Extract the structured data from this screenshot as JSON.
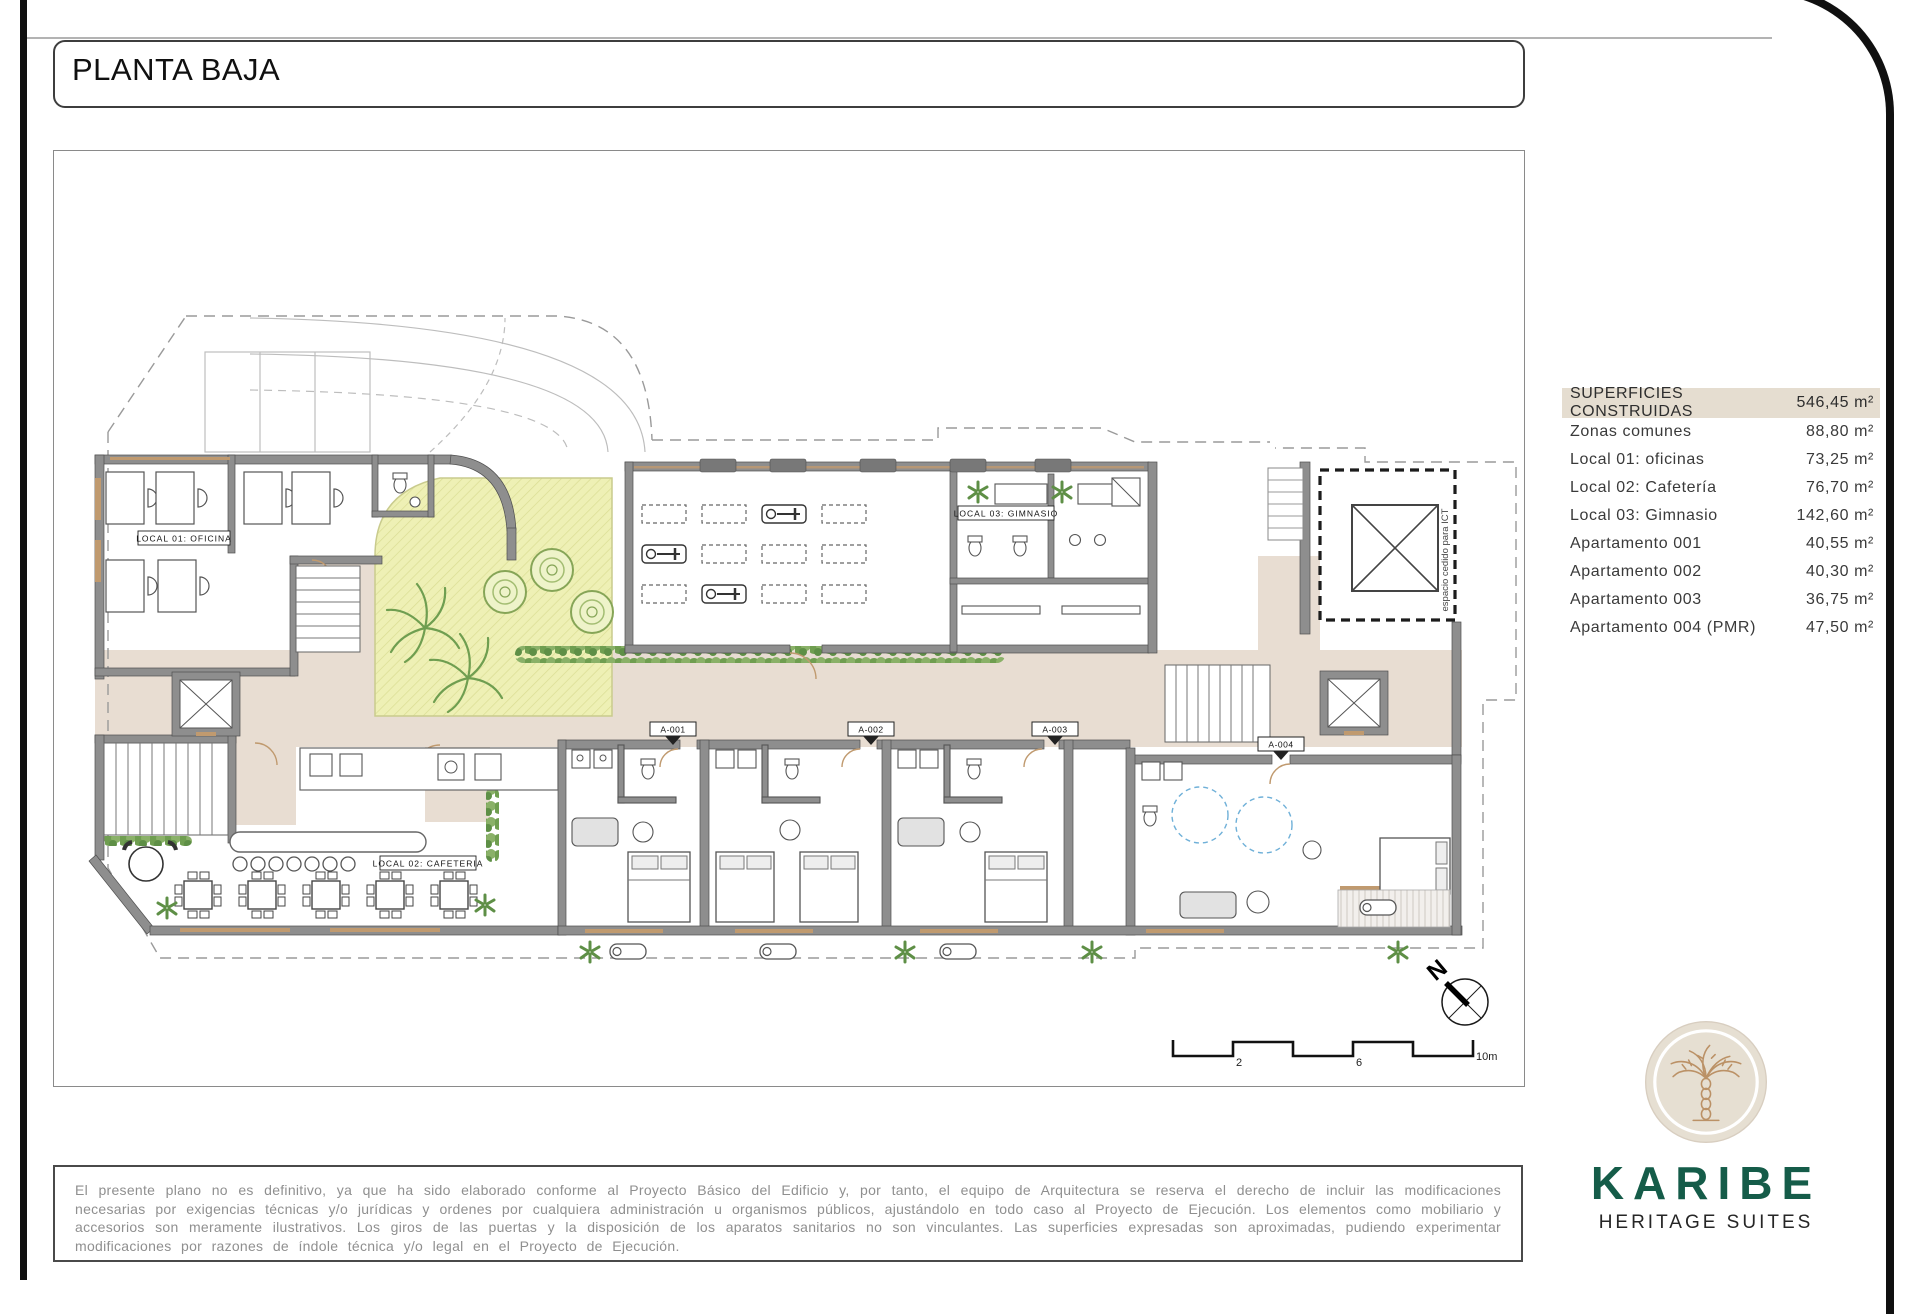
{
  "page": {
    "title": "PLANTA BAJA"
  },
  "plan": {
    "labels": {
      "local01": "LOCAL 01: OFICINA",
      "local02": "LOCAL 02: CAFETERIA",
      "local03": "LOCAL 03: GIMNASIO",
      "ict": "espacio cedido para ICT",
      "north": "N"
    },
    "apartment_tags": [
      "A-001",
      "A-002",
      "A-003",
      "A-004"
    ],
    "scale": {
      "t2": "2",
      "t6": "6",
      "t10": "10m"
    }
  },
  "areas_table": {
    "header": {
      "label": "SUPERFICIES CONSTRUIDAS",
      "value": "546,45 m²"
    },
    "rows": [
      {
        "label": "Zonas comunes",
        "value": "88,80 m²"
      },
      {
        "label": "Local 01:  oficinas",
        "value": "73,25 m²"
      },
      {
        "label": "Local 02:  Cafetería",
        "value": "76,70 m²"
      },
      {
        "label": "Local 03:  Gimnasio",
        "value": "142,60 m²"
      },
      {
        "label": "Apartamento 001",
        "value": "40,55 m²"
      },
      {
        "label": "Apartamento 002",
        "value": "40,30 m²"
      },
      {
        "label": "Apartamento 003",
        "value": "36,75 m²"
      },
      {
        "label": "Apartamento 004 (PMR)",
        "value": "47,50 m²"
      }
    ]
  },
  "disclaimer": {
    "text": "El presente plano no es definitivo, ya que ha sido elaborado conforme al Proyecto Básico del Edificio y, por tanto, el equipo de Arquitectura se reserva el derecho de incluir las modificaciones necesarias por exigencias técnicas y/o jurídicas y ordenes por cualquiera administración u organismos públicos, ajustándolo en todo caso al Proyecto de Ejecución. Los elementos como mobiliario y accesorios son meramente ilustrativos. Los giros de las puertas y la disposición de los aparatos sanitarios no son vinculantes. Las superficies expresadas son aproximadas, pudiendo experimentar modificaciones por razones de índole técnica y/o legal en el Proyecto de Ejecución."
  },
  "logo": {
    "brand": "KARIBE",
    "tagline": "HERITAGE SUITES"
  },
  "colors": {
    "brand_green": "#155c49",
    "logo_circle_beige": "#e6dfd2",
    "palm_tan": "#bb9166",
    "table_header_bg": "#e5ddd0",
    "corridor_beige": "#e8ddd2",
    "garden_yellow": "#eef0b5",
    "plant_green": "#6f9e50",
    "wall_gray": "#8e8e8e",
    "door_tan": "#c09a6f",
    "frame_black": "#101010"
  }
}
